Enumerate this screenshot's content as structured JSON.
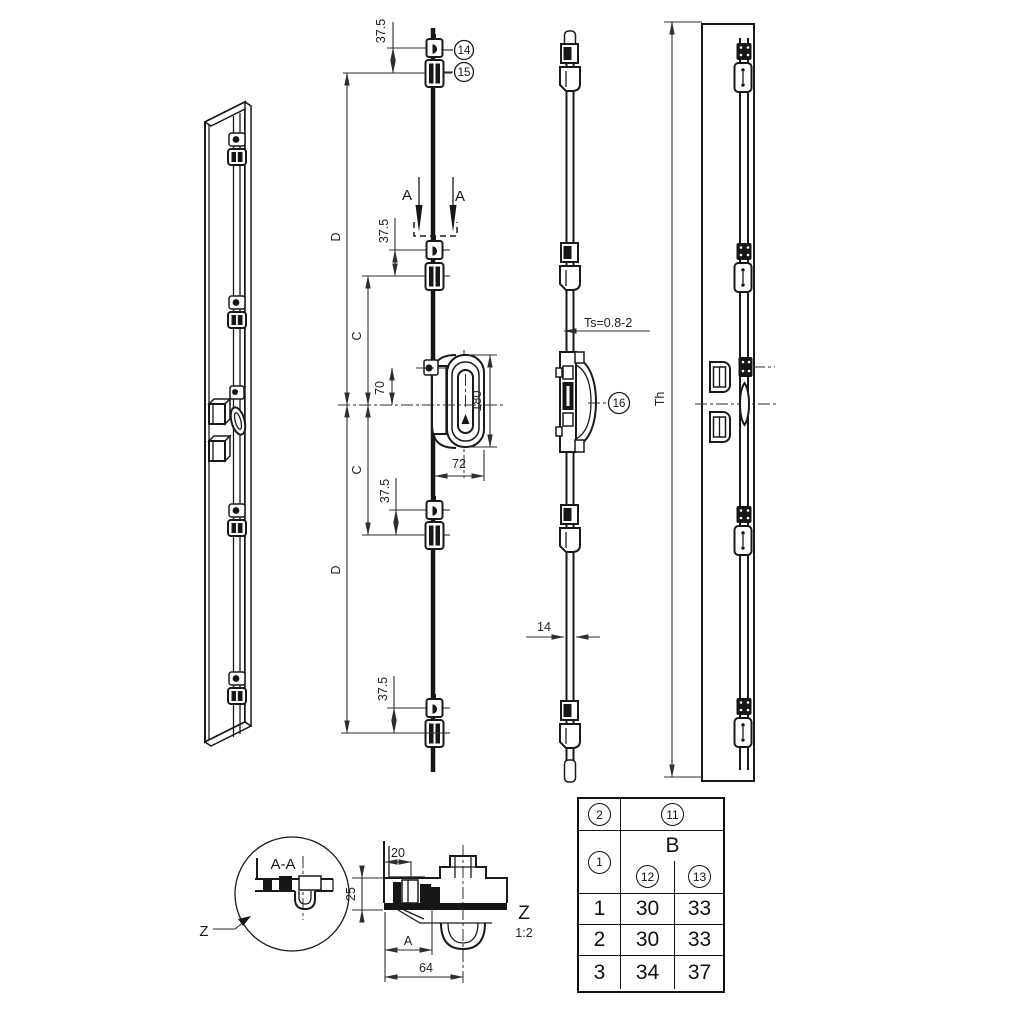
{
  "colors": {
    "background": "#ffffff",
    "line": "#1a1a1a",
    "dimension": "#2e2e2e"
  },
  "front_view": {
    "callout_14": "14",
    "callout_15": "15",
    "section_label": "A",
    "dim_offset": "37.5",
    "dim_span_d": "D",
    "dim_span_c": "C",
    "dim_gear_offset": "70",
    "dim_gear_height": "180",
    "dim_gear_width": "72"
  },
  "side_view": {
    "thickness_label": "Ts=0.8-2",
    "callout_16": "16",
    "dim_width": "14",
    "dim_height": "Th"
  },
  "detail_aa": {
    "title": "A-A",
    "zone_ref": "Z"
  },
  "detail_z": {
    "zone_label": "Z",
    "scale": "1:2",
    "dim_top": "20",
    "dim_left": "25",
    "dim_spacing": "A",
    "dim_bottom": "64"
  },
  "table": {
    "head_row_ref": "2",
    "head_col_ref": "11",
    "head_item_ref": "1",
    "group_label": "B",
    "sub_ref_left": "12",
    "sub_ref_right": "13",
    "rows": [
      {
        "item": "1",
        "left": "30",
        "right": "33"
      },
      {
        "item": "2",
        "left": "30",
        "right": "33"
      },
      {
        "item": "3",
        "left": "34",
        "right": "37"
      }
    ]
  }
}
